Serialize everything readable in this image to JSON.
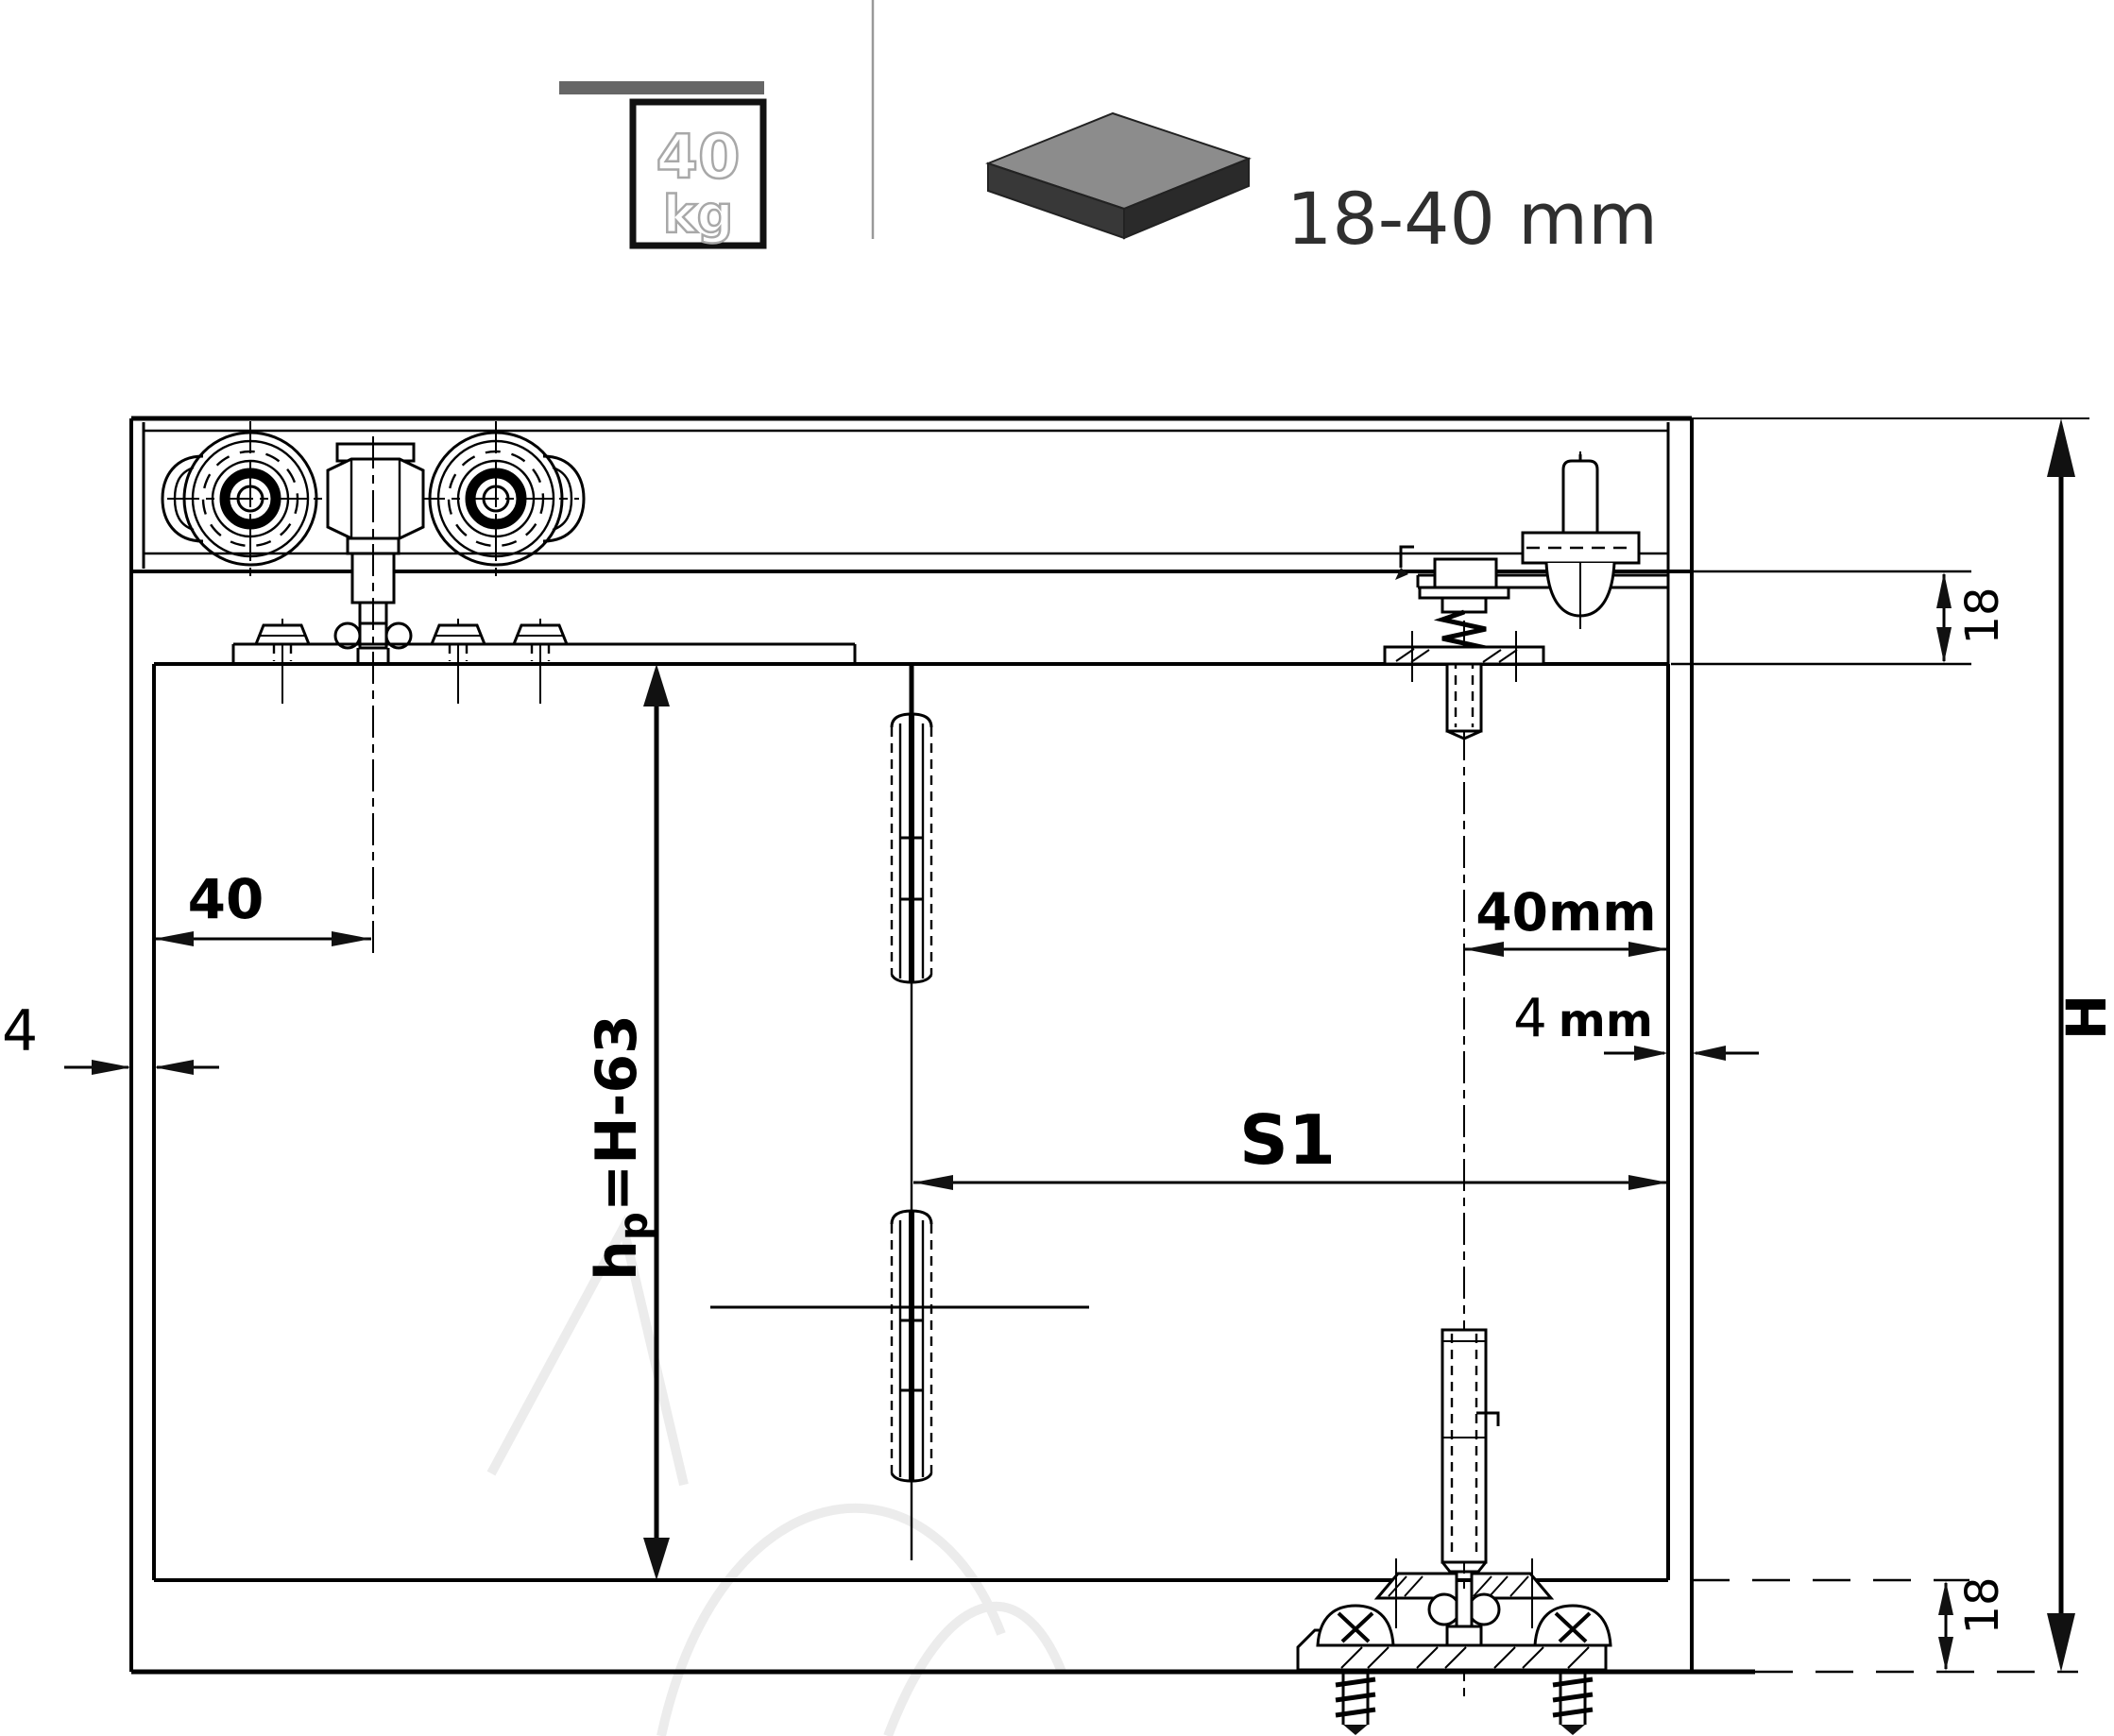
{
  "header": {
    "load": {
      "value": "40",
      "unit": "kg"
    },
    "panel_thickness_label": "18-40 mm"
  },
  "dimensions": {
    "roller_offset": "40",
    "side_gap_left": "4",
    "door_height": {
      "prefix": "h",
      "sub": "p",
      "suffix": "=H-63"
    },
    "top_inset": "18",
    "end_offset": "40mm",
    "end_gap": {
      "value": "4",
      "unit": "mm"
    },
    "travel": "S1",
    "opening_height": "H",
    "bottom_inset": "18"
  },
  "colors": {
    "line": "#000000",
    "icon_bar": "#666666",
    "icon_slab_top": "#8c8c8c",
    "icon_slab_side": "#2f2f2f",
    "divider": "#999999",
    "outline_digit_stroke": "#a8a8a8"
  }
}
